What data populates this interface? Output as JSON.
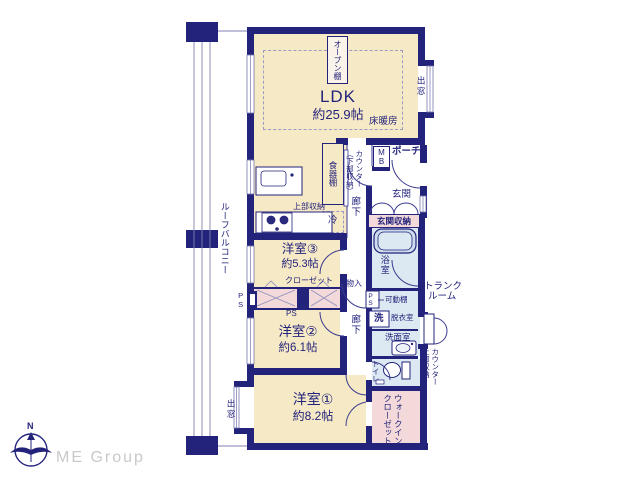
{
  "plan": {
    "ldk": {
      "name": "LDK",
      "size": "約25.9帖"
    },
    "bedroom1": {
      "name": "洋室①",
      "size": "約8.2帖"
    },
    "bedroom2": {
      "name": "洋室②",
      "size": "約6.1帖"
    },
    "bedroom3": {
      "name": "洋室③",
      "size": "約5.3帖"
    },
    "labels": {
      "floor_heating": "床暖房",
      "open_shelf": "オープン棚",
      "bay_window_top": "出窓",
      "bay_window_bottom": "出窓",
      "cupboard": "食器棚",
      "counter_lower_r": "カウンター",
      "counter_lower_l": "（下部収納）",
      "hallway_upper": "廊下",
      "hallway_lower": "廊下",
      "upper_storage_kitchen": "上部収納",
      "fridge": "冷",
      "mb": "MB",
      "porch": "ポーチ",
      "entrance": "玄関",
      "entrance_storage": "玄関収納",
      "bathroom": "浴室",
      "ps_bath": "PS",
      "movable_shelf": "可動棚",
      "laundry": "洗",
      "dressing_room": "脱衣室",
      "washroom": "洗面室",
      "toilet": "トイレ",
      "trunk_line1": "トランク",
      "trunk_line2": "ルーム",
      "counter_upper_r": "カウンター",
      "counter_upper_l": "上部収納",
      "wic_r": "ウォークイン",
      "wic_l": "クローゼット",
      "closet": "クローゼット",
      "ps_left": "PS",
      "ps_center": "PS",
      "storage": "物入",
      "roof_balcony": "ルーフバルコニー"
    },
    "branding": {
      "logo": "ME Group",
      "north": "N"
    },
    "colors": {
      "wall": "#23237b",
      "room": "#f6e9c6",
      "closet_pink": "#f3d9d9",
      "wet_blue": "#dde9f2",
      "logo_gray": "#c9c9c9"
    }
  }
}
